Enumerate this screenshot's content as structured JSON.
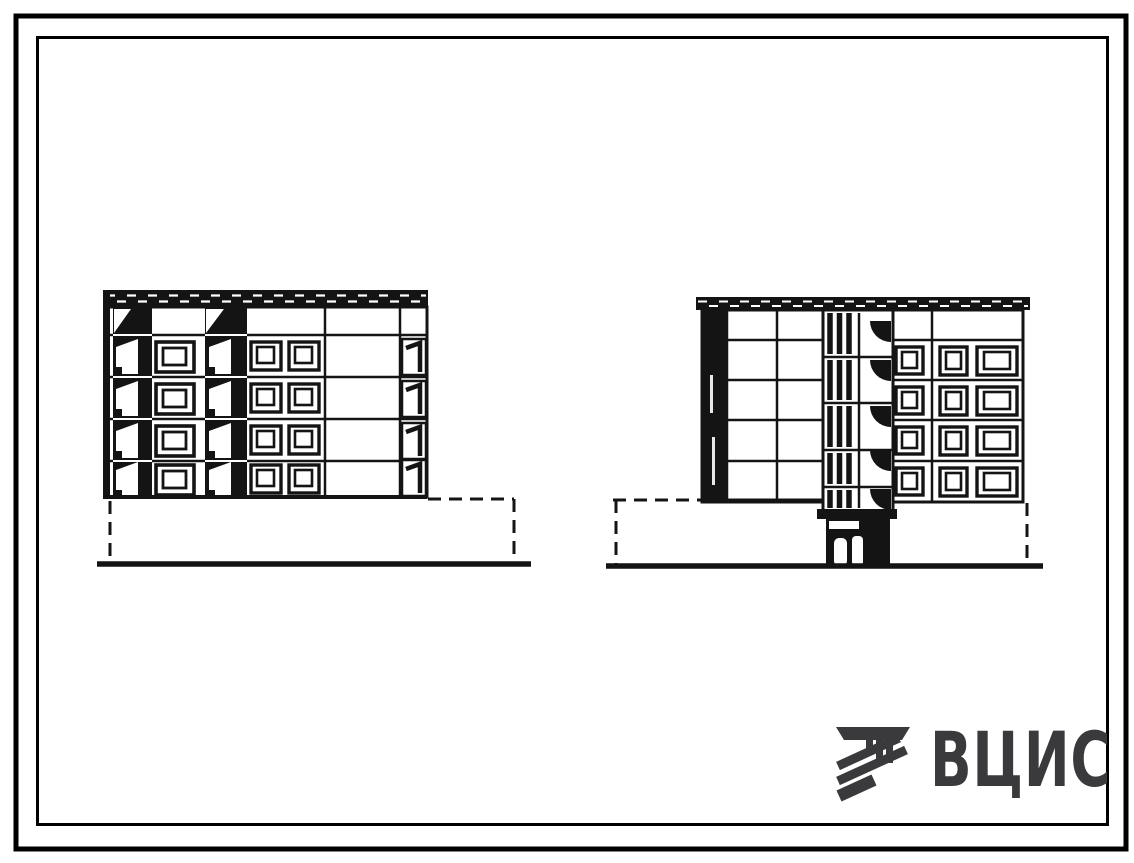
{
  "sheet": {
    "background_color": "#ffffff",
    "ink_color": "#141414",
    "kind": "scanned architectural elevation drawing, two building end elevations"
  },
  "logo": {
    "text": "ВЦИС",
    "color": "#3a3a3c",
    "icon": "hatched-construction-mark-icon"
  },
  "elevations": {
    "left": {
      "storeys": 4,
      "balcony_stacks": 2,
      "balconies_per_stack": 4,
      "single_window_stack_windows": 4,
      "double_window_stack_windows": 8,
      "side_loggia_windows": 4
    },
    "right": {
      "storeys": 4,
      "stairwell_landings": 5,
      "window_rows": 4,
      "windows_per_row": 3,
      "entrance_doors": 2
    }
  }
}
